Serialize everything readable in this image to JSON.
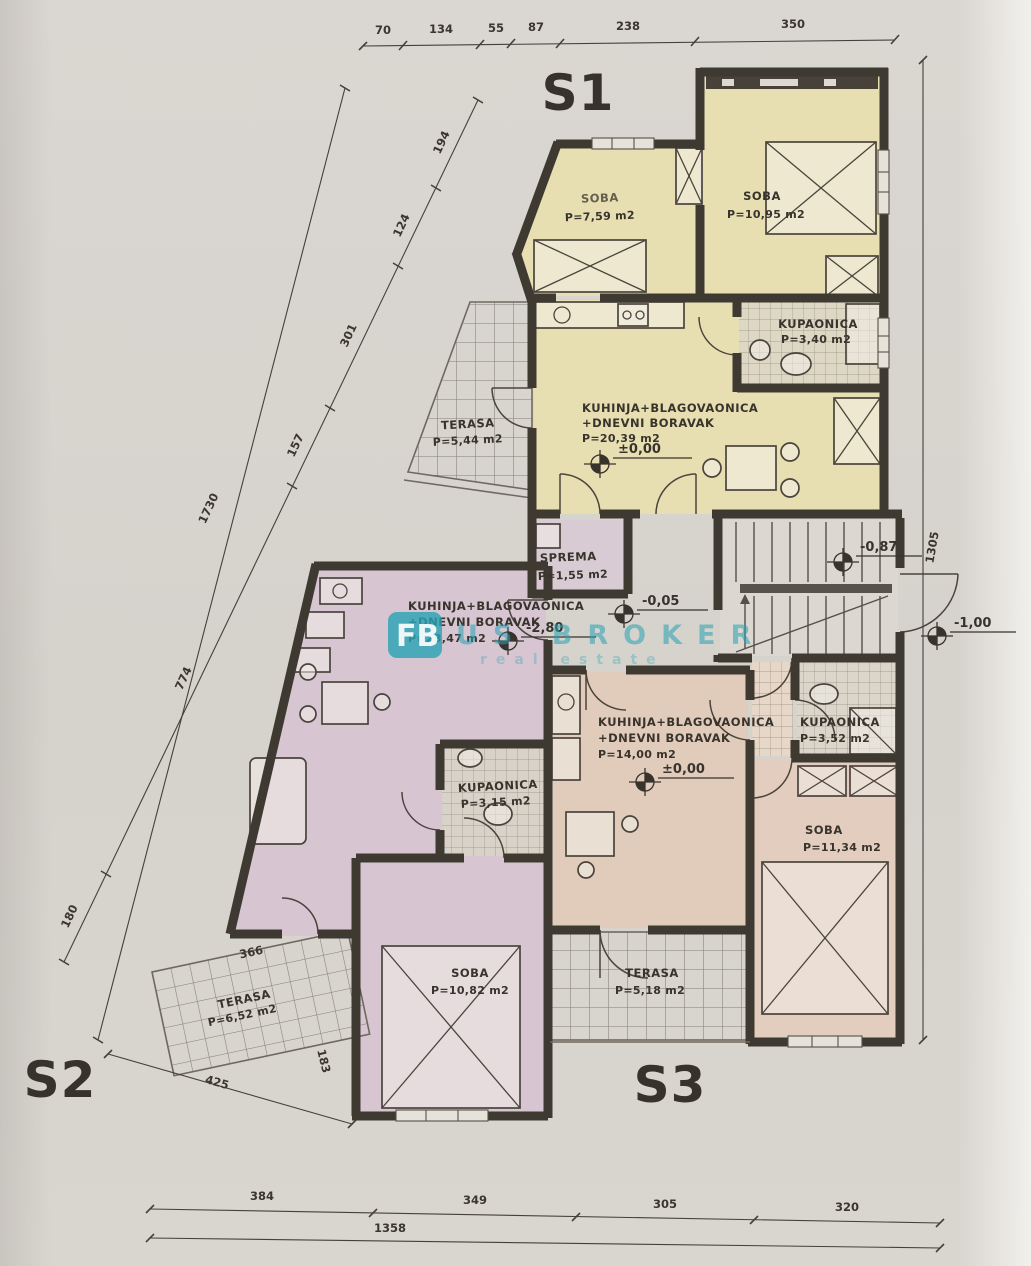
{
  "units": {
    "s1": "S1",
    "s2": "S2",
    "s3": "S3"
  },
  "rooms": {
    "s1_soba_a": {
      "name": "SOBA",
      "area": "P=7,59 m2"
    },
    "s1_soba_b": {
      "name": "SOBA",
      "area": "P=10,95 m2"
    },
    "s1_bath": {
      "name": "KUPAONICA",
      "area": "P=3,40 m2"
    },
    "s1_kitchen": {
      "l1": "KUHINJA+BLAGOVAONICA",
      "l2": "+DNEVNI BORAVAK",
      "area": "P=20,39 m2"
    },
    "s1_terrace": {
      "name": "TERASA",
      "area": "P=5,44 m2"
    },
    "sprema": {
      "name": "SPREMA",
      "area": "P=1,55 m2"
    },
    "s2_kitchen": {
      "l1": "KUHINJA+BLAGOVAONICA",
      "l2": "+DNEVNI BORAVAK",
      "area": "P=23,47 m2"
    },
    "s2_bath": {
      "name": "KUPAONICA",
      "area": "P=3,15 m2"
    },
    "s2_soba": {
      "name": "SOBA",
      "area": "P=10,82 m2"
    },
    "s2_terrace": {
      "name": "TERASA",
      "area": "P=6,52 m2"
    },
    "s3_kitchen": {
      "l1": "KUHINJA+BLAGOVAONICA",
      "l2": "+DNEVNI BORAVAK",
      "area": "P=14,00 m2"
    },
    "s3_bath": {
      "name": "KUPAONICA",
      "area": "P=3,52 m2"
    },
    "s3_soba": {
      "name": "SOBA",
      "area": "P=11,34 m2"
    },
    "s3_terrace": {
      "name": "TERASA",
      "area": "P=5,18 m2"
    }
  },
  "elevations": {
    "s1": "±0,00",
    "s2": "-2,80",
    "s3": "±0,00",
    "stair": "-0,87",
    "hall": "-0,05",
    "entry": "-1,00"
  },
  "dims": {
    "top": [
      "70",
      "134",
      "55",
      "87",
      "238",
      "350"
    ],
    "left": [
      "194",
      "124",
      "301",
      "157",
      "774",
      "180"
    ],
    "left_total": "1730",
    "right_total": "1305",
    "bottom": [
      "384",
      "349",
      "305",
      "320"
    ],
    "bottom_total": "1358",
    "site": {
      "terrace_top": "366",
      "terrace_bottom": "425",
      "terrace_side": "183"
    }
  },
  "watermark": {
    "logo": "FB",
    "brand": "US BROKER",
    "subtext": "real estate"
  },
  "colors": {
    "s1_fill": "#e7dfb2",
    "s2_fill": "#d7c6d2",
    "s3_fill": "#e1ccbb",
    "walls": "#3e3931",
    "watermark_teal": "#27a2b4"
  }
}
